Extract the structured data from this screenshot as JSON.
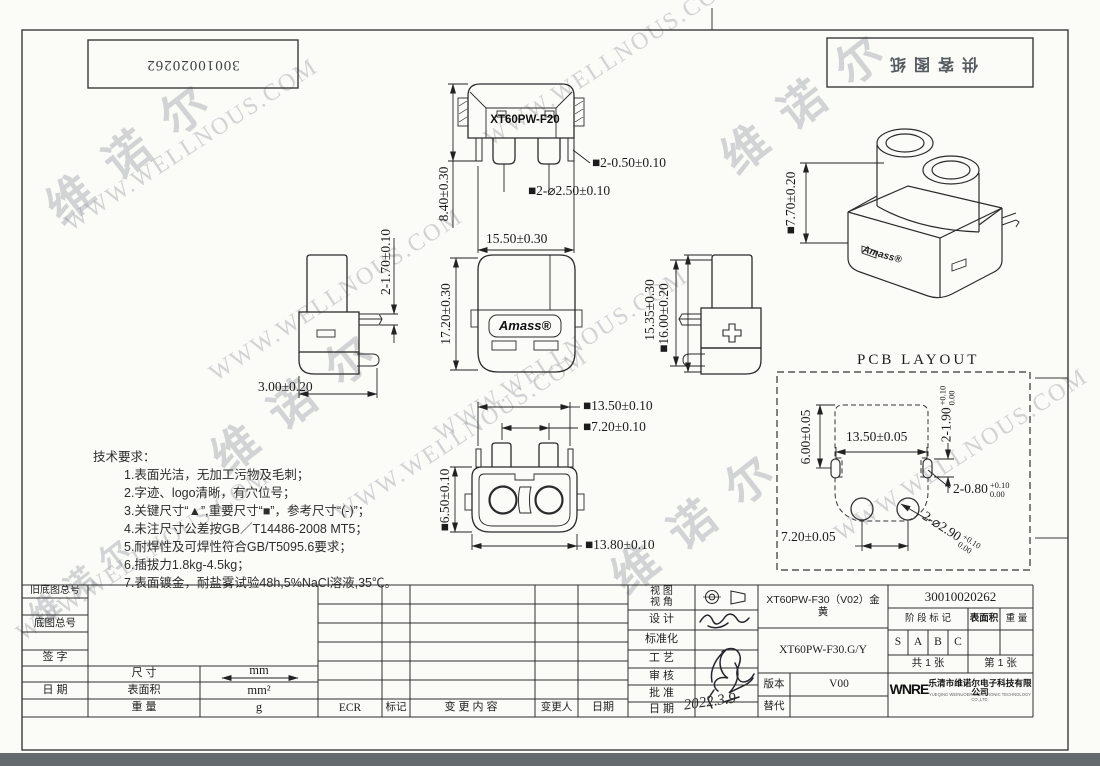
{
  "sheet": {
    "top_left_number": "30010020262",
    "top_right_stamp": "供客图纸"
  },
  "watermark": {
    "url": "WWW.WELLNOUS.COM",
    "brand": "维诺尔"
  },
  "views": {
    "front": {
      "label": "XT60PW-F20",
      "dim_height": "8.40±0.30",
      "dim_pin": "■2-0.50±0.10",
      "dim_dia": "■2-⌀2.50±0.10",
      "dim_width": "15.50±0.30"
    },
    "side_left": {
      "dim_pin": "2-1.70±0.10",
      "dim_offset": "3.00±0.20"
    },
    "front_center": {
      "logo": "Amass®",
      "dim_height": "17.20±0.30"
    },
    "side_right": {
      "plus": "+",
      "dim_h1": "15.35±0.30",
      "dim_h2": "■16.00±0.20"
    },
    "iso": {
      "logo": "Amass®",
      "dim_height": "■7.70±0.20"
    },
    "bottom": {
      "dim_w1": "■13.50±0.10",
      "dim_w2": "■7.20±0.10",
      "dim_h": "■6.50±0.10",
      "dim_w3": "■13.80±0.10"
    }
  },
  "pcb": {
    "title": "PCB LAYOUT",
    "dim_v": "6.00±0.05",
    "dim_w": "13.50±0.05",
    "slot_len": "2-1.90",
    "slot_len_tol_up": "+0.10",
    "slot_len_tol_dn": "0.00",
    "slot_wid": "2-0.80",
    "slot_wid_tol_up": "+0.10",
    "slot_wid_tol_dn": "0.00",
    "pitch": "7.20±0.05",
    "hole": "2-⌀2.90",
    "hole_tol_up": "+0.10",
    "hole_tol_dn": "0.00"
  },
  "tech": {
    "title": "技术要求：",
    "items": [
      "1.表面光洁，无加工污物及毛刺；",
      "2.字迹、logo清晰，有穴位号；",
      "3.关键尺寸“▲”,重要尺寸“■”，参考尺寸“(-)”；",
      "4.未注尺寸公差按GB／T14486-2008 MT5；",
      "5.耐焊性及可焊性符合GB/T5095.6要求；",
      "6.插拔力1.8kg-4.5kg；",
      "7.表面镀金，耐盐雾试验48h,5%NaCl溶液,35℃。"
    ]
  },
  "title_block": {
    "old_base_no_label": "旧底图总号",
    "base_no_label": "底图总号",
    "sign_label": "签  字",
    "date_label": "日  期",
    "size_label": "尺  寸",
    "size_value": "mm",
    "surface_label": "表面积",
    "surface_value": "mm²",
    "weight_label": "重  量",
    "weight_value": "g",
    "rev_headers": [
      "ECR",
      "标记",
      "变更内容",
      "变更人",
      "日期"
    ],
    "approval_labels": [
      "视 图\n视 角",
      "设  计",
      "标准化",
      "工  艺",
      "审  核",
      "批  准",
      "日  期"
    ],
    "approval_date": "2022.3.9",
    "product_name": "XT60PW-F30（V02）金 黄",
    "product_model": "XT60PW-F30.G/Y",
    "version_label": "版本",
    "version_value": "V00",
    "replace_label": "替代",
    "doc_number": "30010020262",
    "stage_label": "阶 段 标 记",
    "surface_col_label": "表面积",
    "weight_col_label": "重 量",
    "stages": [
      "S",
      "A",
      "B",
      "C"
    ],
    "sheet_total": "共 1 张",
    "sheet_index": "第 1 张",
    "company_logo": "WNRE",
    "company_cn": "乐清市维诺尔电子科技有限公司",
    "company_en": "YUEQING WEINUOER ELECTRONIC TECHNOLOGY CO.,LTD."
  }
}
